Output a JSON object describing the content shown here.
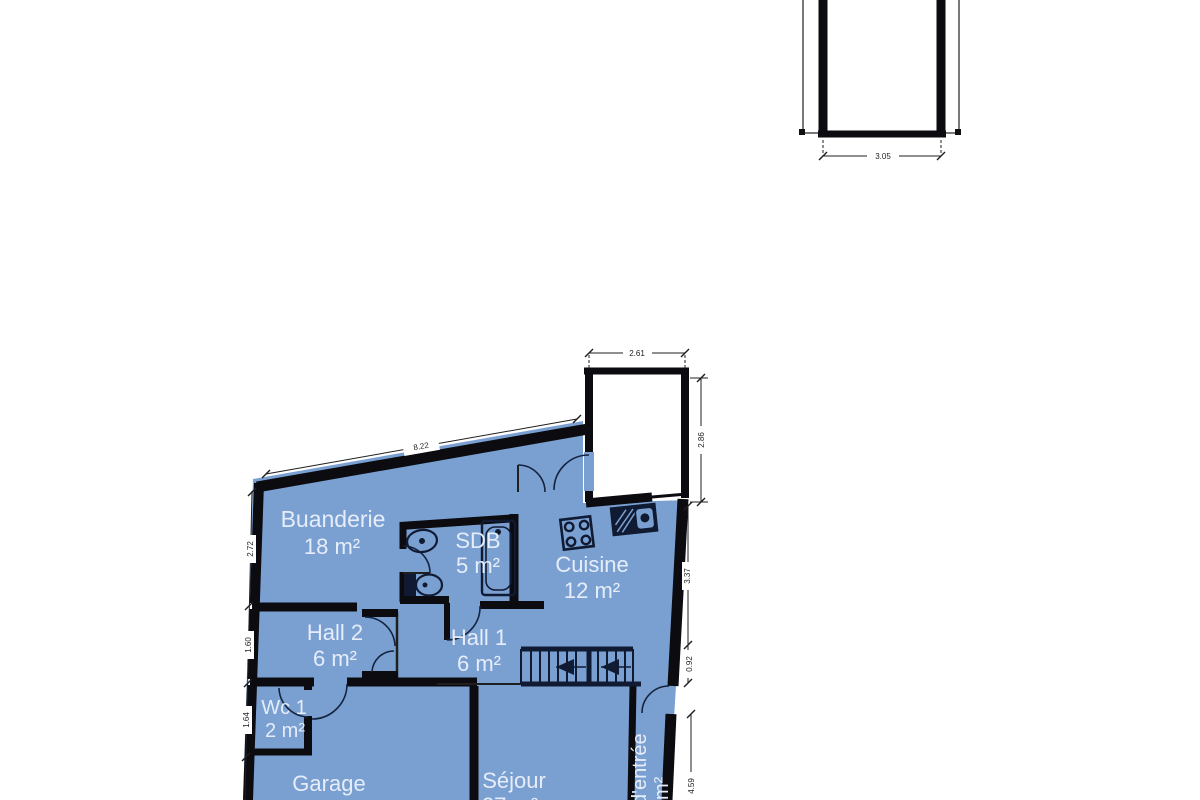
{
  "plan": {
    "rooms": [
      {
        "id": "buanderie",
        "name": "Buanderie",
        "area": "18 m²"
      },
      {
        "id": "sdb",
        "name": "SDB",
        "area": "5 m²"
      },
      {
        "id": "cuisine",
        "name": "Cuisine",
        "area": "12 m²"
      },
      {
        "id": "hall2",
        "name": "Hall 2",
        "area": "6 m²"
      },
      {
        "id": "hall1",
        "name": "Hall 1",
        "area": "6 m²"
      },
      {
        "id": "wc1",
        "name": "Wc 1",
        "area": "2 m²"
      },
      {
        "id": "garage",
        "name": "Garage",
        "area": ""
      },
      {
        "id": "sejour",
        "name": "Séjour",
        "area": "27 m²"
      },
      {
        "id": "hall-entree",
        "name": "d'entrée",
        "area": "m²"
      }
    ],
    "dimensions": {
      "top_wall": "8.22",
      "annex_width": "3.05",
      "terrace_width": "2.61",
      "terrace_height": "2.86",
      "left": [
        "2.72",
        "1.60",
        "1.64"
      ],
      "right": [
        "3.37",
        "0.92",
        "4.59"
      ]
    },
    "colors": {
      "room_fill": "#7AA0D2",
      "wall": "#0B0B10",
      "fixture": "#101B33",
      "label": "#E6EDF9",
      "dimension": "#1F1F1F"
    }
  }
}
